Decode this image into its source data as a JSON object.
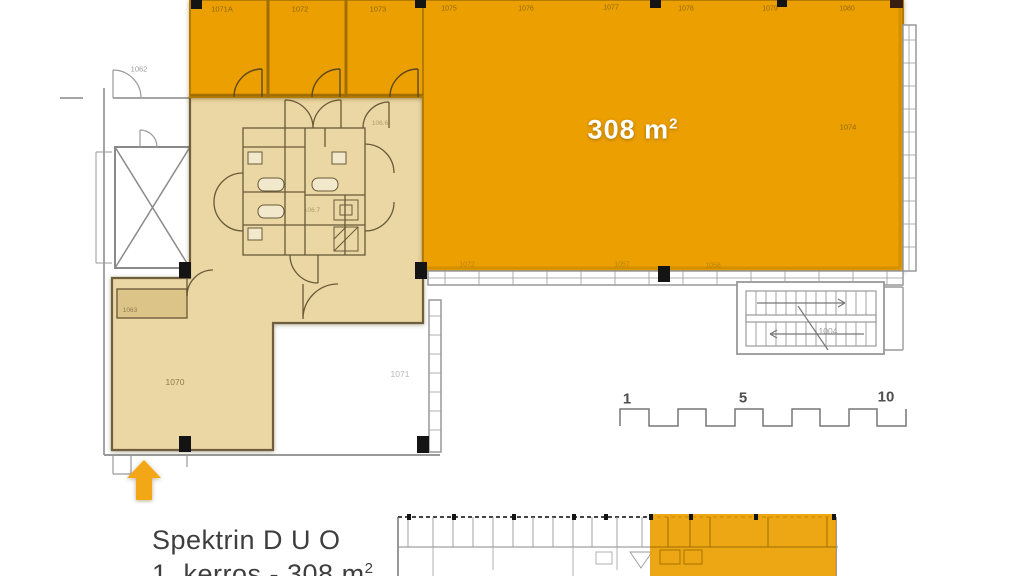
{
  "plan": {
    "area_text": "308 m",
    "area_sup": "2",
    "area_room_number": "1074",
    "top_room_labels": [
      "1071A",
      "1072",
      "1073"
    ],
    "top_edge_labels": [
      "1075",
      "1076",
      "1077",
      "1078",
      "1079",
      "1080"
    ],
    "bottom_edge_labels": [
      "1072",
      "1057",
      "1056"
    ],
    "door_label_top_left": "1062",
    "small_room_label": "1063",
    "room_bottom_left": "1070",
    "room_bottom_mid": "1071",
    "staircase_label": "1004",
    "wc_label_left": "106.6",
    "wc_label_right": "106.7"
  },
  "scale_bar": {
    "tick_1": "1",
    "tick_5": "5",
    "tick_10": "10"
  },
  "footer": {
    "title": "Spektrin  D U O",
    "subtitle": "1. kerros - 308 m",
    "subtitle_sup": "2"
  },
  "colors": {
    "highlight_orange": "#EC9F00",
    "common_beige": "#EBD7A4",
    "arrow_orange": "#F3A716",
    "wall_brown": "#6F5F3C",
    "line_gray": "#9A9A9A",
    "text_dark": "#3E3E3E"
  }
}
